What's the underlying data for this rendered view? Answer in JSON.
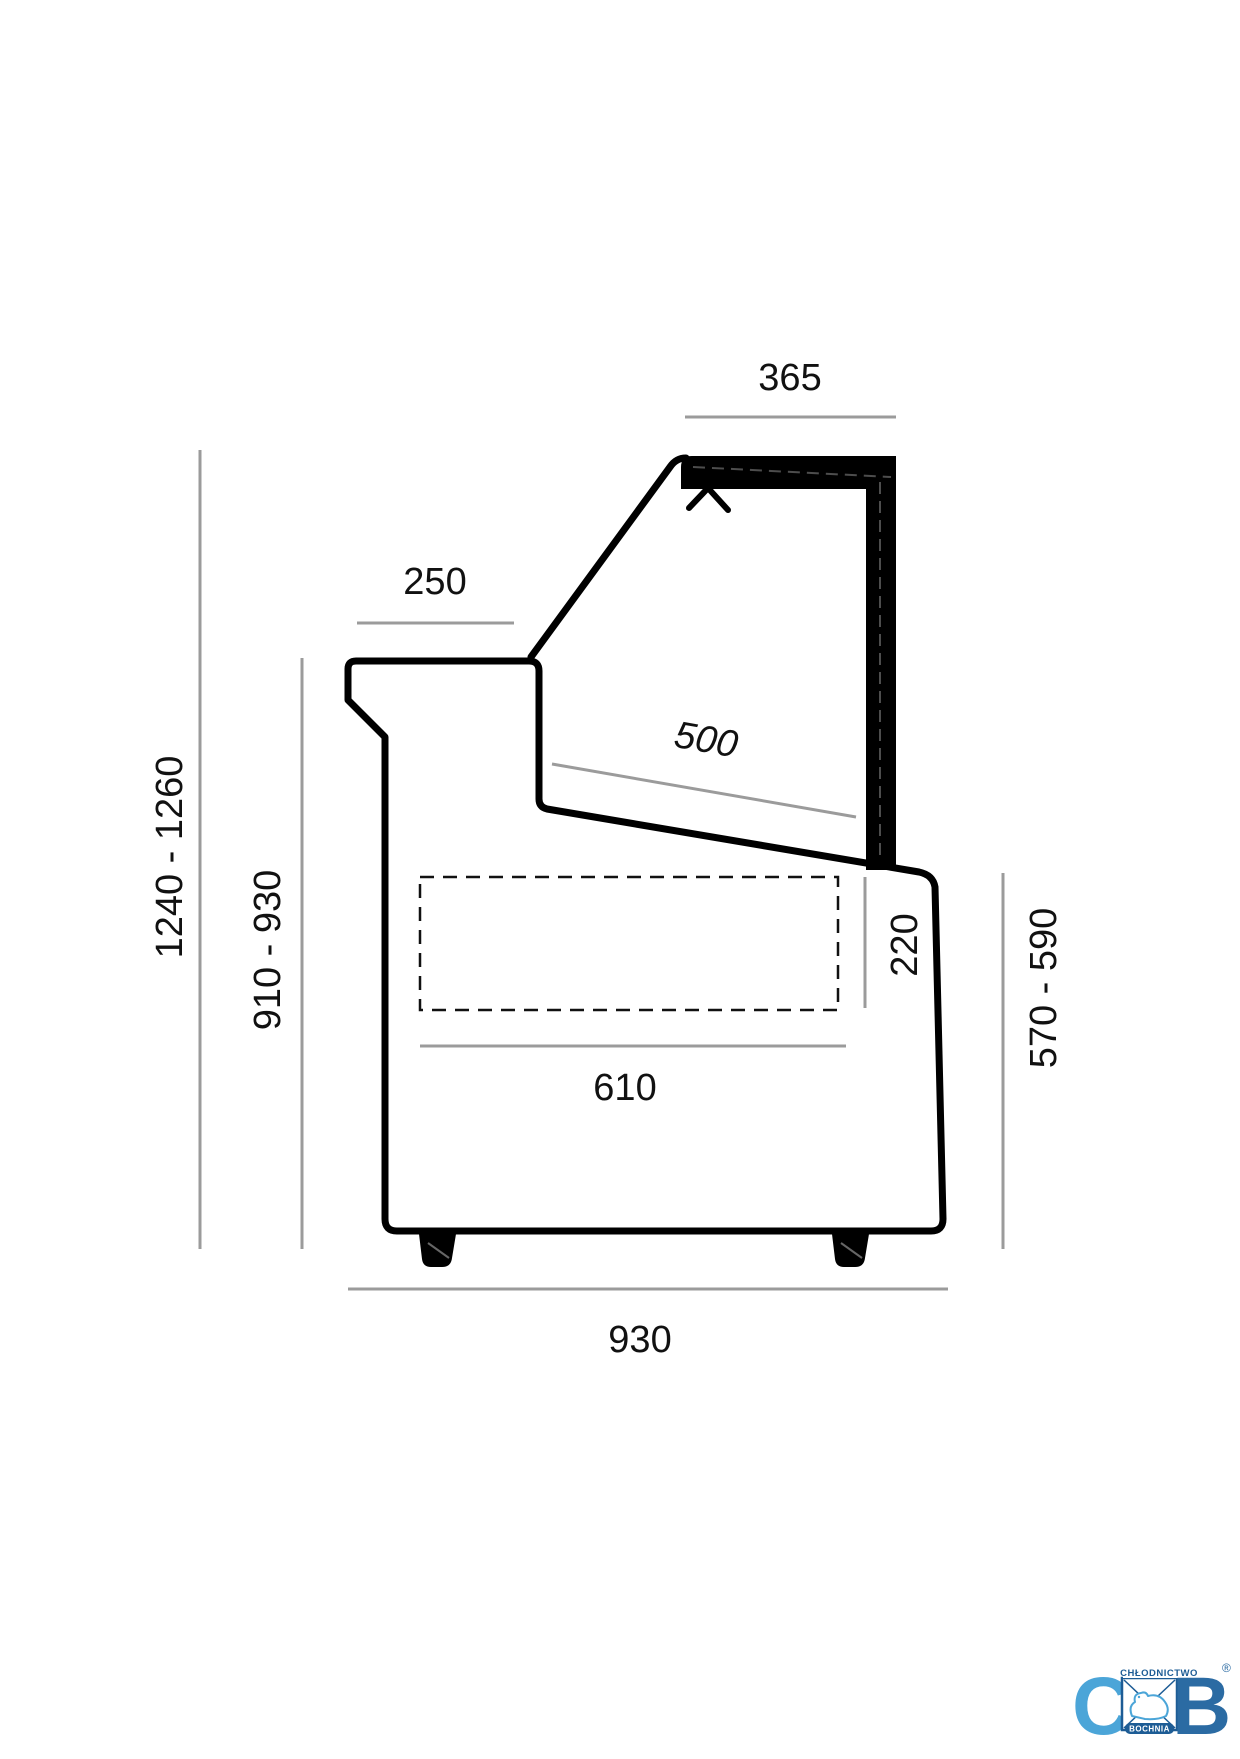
{
  "colors": {
    "outline": "#000000",
    "dim_line": "#9B9B9B",
    "dim_text": "#111111",
    "logo_light_blue": "#4BA5D8",
    "logo_dark_blue": "#2B6BA3",
    "logo_navy": "#1D5C95"
  },
  "dimensions": {
    "canopy_width": "365",
    "rear_worktop_depth": "250",
    "display_deck_depth": "500",
    "overall_height": "1240 - 1260",
    "worktop_height": "910 - 930",
    "well_height": "220",
    "base_depth": "610",
    "front_panel_height": "570 - 590",
    "overall_depth": "930"
  },
  "logo": {
    "letter_c": "C",
    "letter_b": "B",
    "top_text": "CHŁODNICTWO",
    "bottom_text": "BOCHNIA",
    "registered_mark": "®"
  }
}
